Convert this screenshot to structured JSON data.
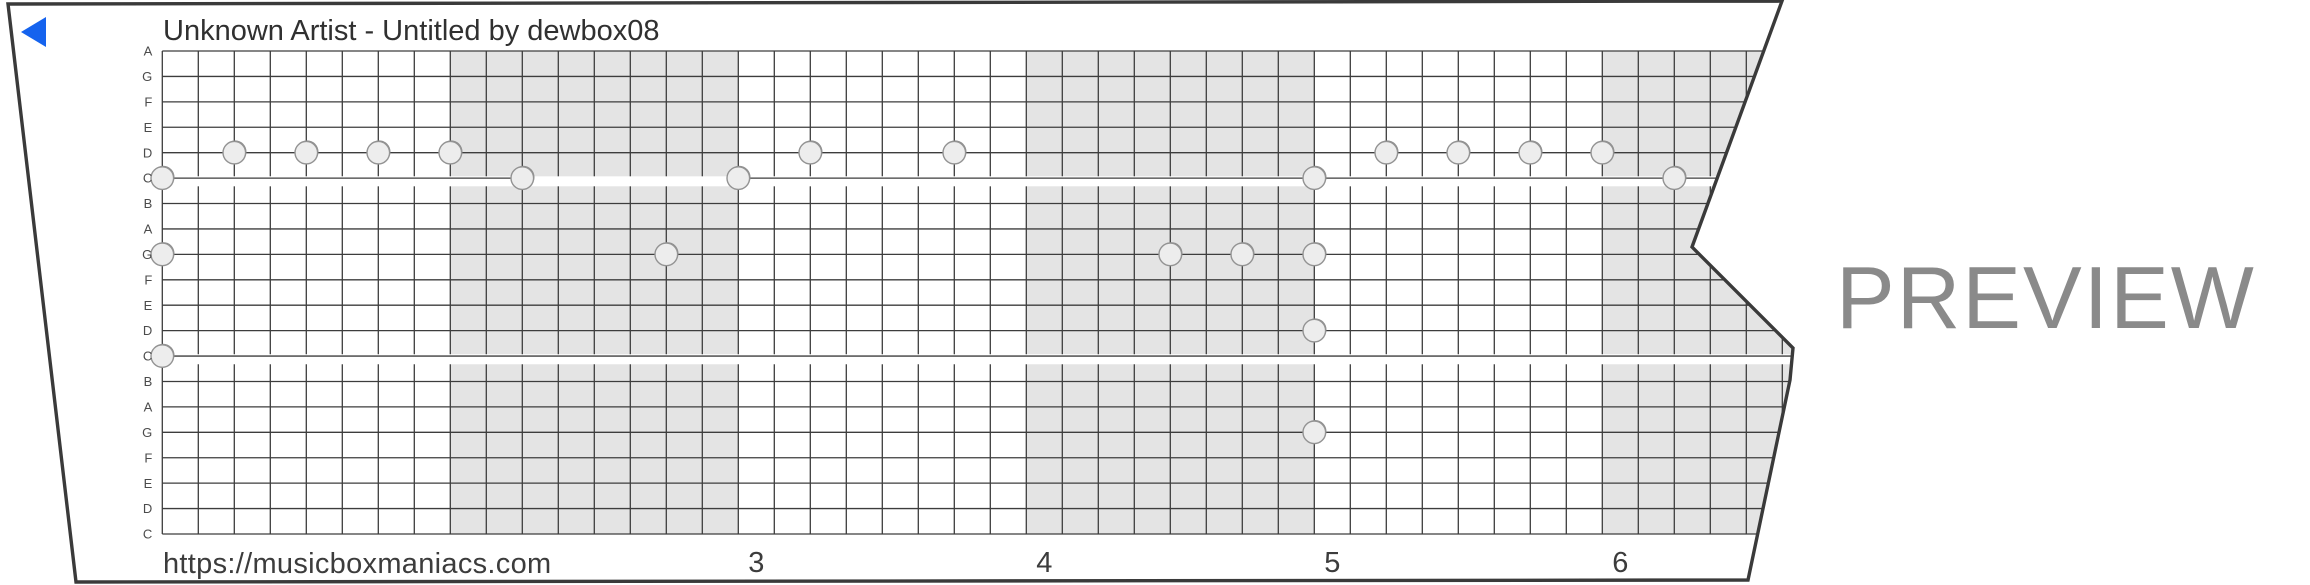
{
  "header": {
    "title": "Unknown Artist - Untitled by dewbox08"
  },
  "watermark": "PREVIEW",
  "footer": {
    "url": "https://musicboxmaniacs.com"
  },
  "strip": {
    "row_labels": [
      "A",
      "G",
      "F",
      "E",
      "D",
      "C",
      "B",
      "A",
      "G",
      "F",
      "E",
      "D",
      "C",
      "B",
      "A",
      "G",
      "F",
      "E",
      "D",
      "C"
    ],
    "columns_per_measure": 8,
    "shaded_measures": [
      2,
      4,
      6
    ],
    "measure_numbers": [
      "3",
      "4",
      "5",
      "6"
    ],
    "first_numbered_measure": 3,
    "stripe_rows": [
      5,
      12
    ],
    "c_line_segments": [
      {
        "row": 5,
        "from_col": null,
        "to_col": 10
      },
      {
        "row": 5,
        "from_col": 16,
        "to_col": null
      },
      {
        "row": 12,
        "from_col": null,
        "to_col": null
      }
    ],
    "notes": [
      {
        "row": 4,
        "col": 2
      },
      {
        "row": 4,
        "col": 4
      },
      {
        "row": 4,
        "col": 6
      },
      {
        "row": 4,
        "col": 8
      },
      {
        "row": 4,
        "col": 18
      },
      {
        "row": 4,
        "col": 22
      },
      {
        "row": 4,
        "col": 34
      },
      {
        "row": 4,
        "col": 36
      },
      {
        "row": 4,
        "col": 38
      },
      {
        "row": 4,
        "col": 40
      },
      {
        "row": 5,
        "col": 0
      },
      {
        "row": 5,
        "col": 10
      },
      {
        "row": 5,
        "col": 16
      },
      {
        "row": 5,
        "col": 32
      },
      {
        "row": 5,
        "col": 42
      },
      {
        "row": 8,
        "col": 0
      },
      {
        "row": 8,
        "col": 14
      },
      {
        "row": 8,
        "col": 28
      },
      {
        "row": 8,
        "col": 30
      },
      {
        "row": 8,
        "col": 32
      },
      {
        "row": 11,
        "col": 32
      },
      {
        "row": 12,
        "col": 0
      },
      {
        "row": 15,
        "col": 32
      }
    ]
  },
  "colors": {
    "play_button": "#1563ee",
    "shading": "#e4e4e4",
    "grid_line": "#3d3d3d",
    "outline": "#3a3a3a",
    "note_fill": "#ededed",
    "note_stroke": "#939393",
    "note_shadow": "#8d8d8d",
    "row_label": "#4b4b4b",
    "footer_text": "#3c3c3c",
    "watermark": "#8a8a8a"
  }
}
